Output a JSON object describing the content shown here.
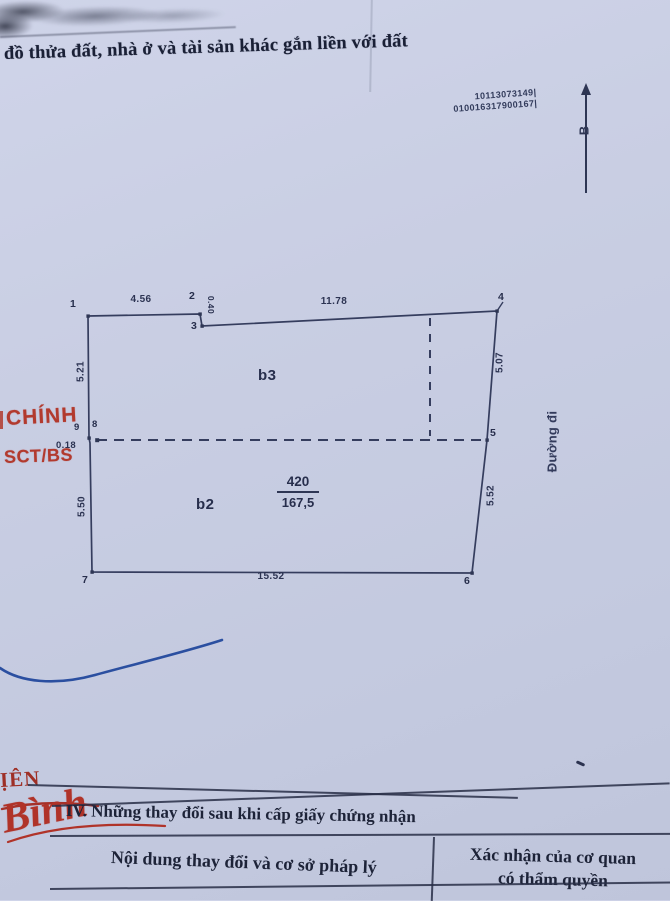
{
  "colors": {
    "paper": "#c9cee3",
    "ink": "#2e3654",
    "text": "#1d2338",
    "red": "#b23a2e",
    "blue_pen": "#2b4fa0"
  },
  "header": {
    "title": "đồ thửa đất, nhà ở và tài sản khác gắn liền với đất",
    "code_line1": "10113073149|",
    "code_line2": "010016317900167|",
    "north_label": "B"
  },
  "left_stamp": {
    "line1": "CHÍNH",
    "line2": "SCT/BS"
  },
  "diagram": {
    "zone_top": "b3",
    "zone_bottom": "b2",
    "parcel_number": "420",
    "area": "167,5",
    "road": "Đường đi",
    "points": {
      "p1": "1",
      "p2": "2",
      "p3": "3",
      "p4": "4",
      "p5": "5",
      "p6": "6",
      "p7": "7",
      "p8": "8",
      "p9": "9"
    },
    "dims": {
      "top_left": "4.56",
      "notch": "0.40",
      "top_right": "11.78",
      "left_upper": "5.21",
      "right_upper": "5.07",
      "step": "0.18",
      "left_lower": "5.50",
      "right_lower": "5.52",
      "bottom": "15.52"
    }
  },
  "footer": {
    "fragment": "ỊÊN",
    "signature": "Bình",
    "section_title": "IV. Những thay đổi sau khi cấp giấy chứng nhận",
    "col_left": "Nội dung thay đổi và cơ sở pháp lý",
    "col_right_line1": "Xác nhận của cơ quan",
    "col_right_line2": "có thẩm quyền"
  }
}
